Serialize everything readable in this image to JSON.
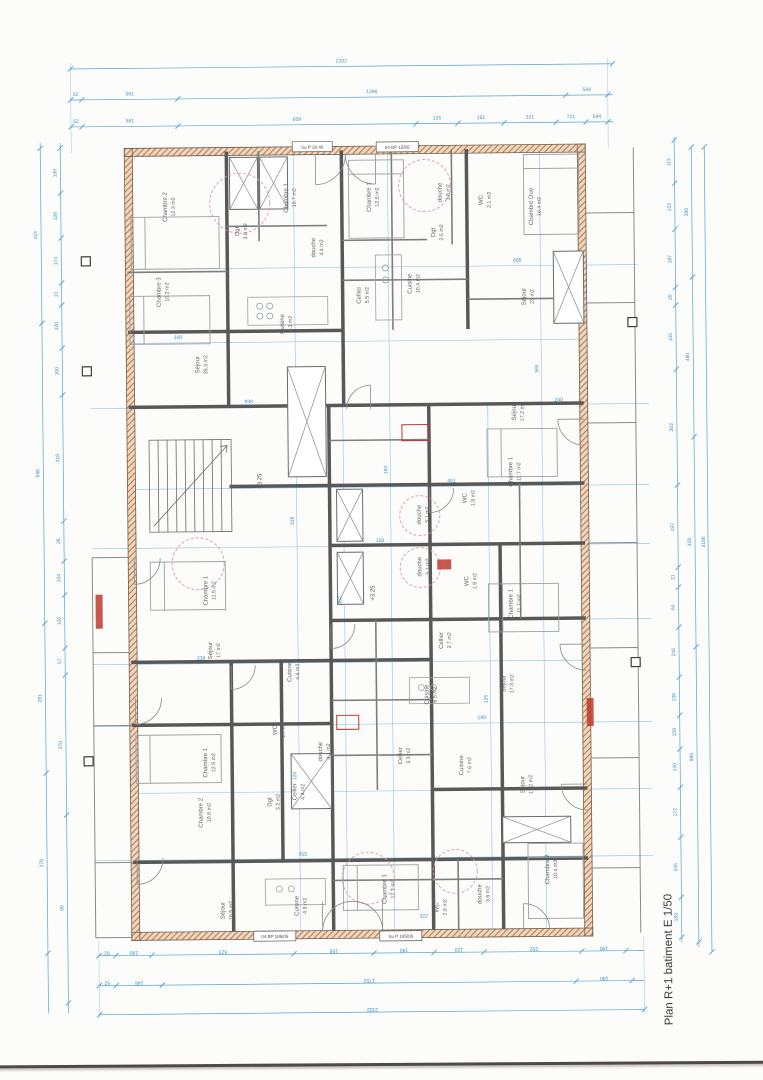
{
  "title": "Plan R+1 batiment E  1/50",
  "colors": {
    "dimension_blue": "#55a4d6",
    "wall_gray": "#585858",
    "hatch_fill": "#ecd9c3",
    "hatch_line": "#c1723f",
    "accent_red": "#c0392b",
    "shower_pink": "#e29a9a"
  },
  "levels": [
    "+3.25",
    "+3.25"
  ],
  "tags": [
    {
      "label": "Su P 20.40"
    },
    {
      "label": "04 BP 15/05"
    },
    {
      "label": "04 BP 185/05"
    },
    {
      "label": "Su P 185/05"
    }
  ],
  "rooms": [
    {
      "n": "Chambre 2",
      "a": "12.3 m2"
    },
    {
      "n": "Chambre 3",
      "a": "10.2 m2"
    },
    {
      "n": "Chambre 1",
      "a": "10.7 m2"
    },
    {
      "n": "Dgt",
      "a": "3.8 m2"
    },
    {
      "n": "douche",
      "a": "4.4 m2"
    },
    {
      "n": "Cuisine",
      "a": "7.3 m2"
    },
    {
      "n": "Séjour",
      "a": "35.3 m2"
    },
    {
      "n": "Chambre 1",
      "a": "12.5 m2"
    },
    {
      "n": "douche",
      "a": "3.8 m2"
    },
    {
      "n": "WC",
      "a": "2.1 m2"
    },
    {
      "n": "Chambre Duo",
      "a": "16.4 m2"
    },
    {
      "n": "Dgt",
      "a": "2.5 m2"
    },
    {
      "n": "Cellier",
      "a": "5.5 m2"
    },
    {
      "n": "Cuisine",
      "a": "10.4 m2"
    },
    {
      "n": "Séjour",
      "a": "23 m2"
    },
    {
      "n": "douche",
      "a": "5.1 m2"
    },
    {
      "n": "WC",
      "a": "1.9 m2"
    },
    {
      "n": "Séjour",
      "a": "17.2 m2"
    },
    {
      "n": "Chambre 1",
      "a": "11.7 m2"
    },
    {
      "n": "douche",
      "a": "5.1 m2"
    },
    {
      "n": "WC",
      "a": "1.9 m2"
    },
    {
      "n": "Chambre 1",
      "a": "11.7 m2"
    },
    {
      "n": "Chambre 1",
      "a": "11.5 m2"
    },
    {
      "n": "Séjour",
      "a": "17 m2"
    },
    {
      "n": "Cuisine",
      "a": "4.6 m2"
    },
    {
      "n": "WC",
      "a": "1.7 m2"
    },
    {
      "n": "douche",
      "a": "4.1 m2"
    },
    {
      "n": "Chambre 1",
      "a": "12.5 m2"
    },
    {
      "n": "Cellier",
      "a": "4.4 m2"
    },
    {
      "n": "Dgt",
      "a": "3.2 m2"
    },
    {
      "n": "Chambre 2",
      "a": "10.6 m2"
    },
    {
      "n": "Cellier",
      "a": "2.7 m2"
    },
    {
      "n": "Cuisine",
      "a": "6.5 m2"
    },
    {
      "n": "Séjour",
      "a": "17.3 m2"
    },
    {
      "n": "Cellier",
      "a": "3.3 m2"
    },
    {
      "n": "Cuisine",
      "a": "7.6 m2"
    },
    {
      "n": "Séjour",
      "a": "17.2 m2"
    },
    {
      "n": "Séjour",
      "a": "16.5 m2"
    },
    {
      "n": "Cuisine",
      "a": "4.9 m2"
    },
    {
      "n": "Chambre 1",
      "a": "12.1 m2"
    },
    {
      "n": "WC",
      "a": "2.9 m2"
    },
    {
      "n": "douche",
      "a": "3.6 m2"
    },
    {
      "n": "Chambre 2",
      "a": "10.4 m2"
    }
  ],
  "dims": {
    "top": {
      "total": "2102",
      "row2": [
        "52",
        "561",
        "1396",
        "544"
      ],
      "row3": [
        "52",
        "561",
        "609",
        "125",
        "181",
        "321",
        "721",
        "544"
      ]
    },
    "bottom": {
      "total": "2102",
      "rowA": [
        "52",
        "190",
        "623",
        "159",
        "190",
        "120",
        "202",
        "190"
      ],
      "rowB": [
        "52",
        "148",
        "1752",
        "190"
      ]
    },
    "left": {
      "totals": [
        "424",
        "598",
        "281",
        "278"
      ],
      "segs": [
        "130",
        "120",
        "174",
        "21",
        "120",
        "100",
        "318",
        "26",
        "104",
        "120",
        "57",
        "270",
        "90"
      ]
    },
    "right": {
      "grand": "3186",
      "totals": [
        "390",
        "480",
        "458",
        "990"
      ],
      "segs": [
        "113",
        "123",
        "187",
        "20",
        "105",
        "302",
        "197",
        "21",
        "64",
        "246",
        "136",
        "158",
        "120",
        "172",
        "245",
        "189"
      ]
    },
    "interior": [
      "318",
      "302",
      "160",
      "125",
      "565",
      "120",
      "938",
      "451",
      "158",
      "238",
      "190",
      "915",
      "665",
      "100",
      "322",
      "240"
    ]
  }
}
